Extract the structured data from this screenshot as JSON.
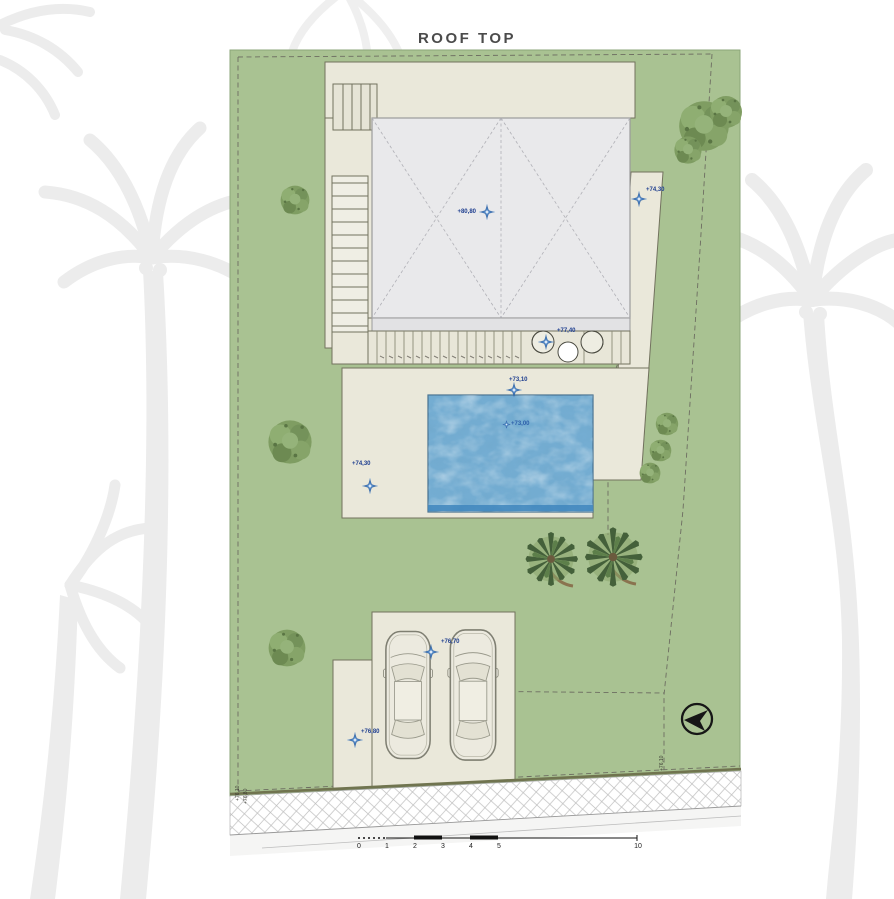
{
  "title": "ROOF TOP",
  "plan": {
    "name": "villa-roof-top-site-plan",
    "levels": [
      {
        "area": "roof",
        "label": "+80,80"
      },
      {
        "area": "terrace-east",
        "label": "+74,30"
      },
      {
        "area": "pergola-deck",
        "label": "+77,40"
      },
      {
        "area": "pool-deck-north",
        "label": "+73,10"
      },
      {
        "area": "pool-water",
        "label": "+73,00"
      },
      {
        "area": "pool-deck-west",
        "label": "+74,30"
      },
      {
        "area": "driveway-north",
        "label": "+76,70"
      },
      {
        "area": "driveway-west",
        "label": "+76,80"
      }
    ],
    "boundary_labels": [
      {
        "label": "+76,10"
      },
      {
        "label": "+76,80"
      },
      {
        "label": "+76,10"
      }
    ]
  },
  "scale_bar": {
    "labels": [
      "0",
      "1",
      "2",
      "3",
      "4",
      "5",
      "10"
    ]
  },
  "icons": {
    "north_arrow": "compass-circle-arrow",
    "level_marker": "blue-sparkle-cross"
  },
  "colors": {
    "grass": "#a9c292",
    "terrace": "#eae8da",
    "roof": "#e9e9eb",
    "pool_water": "#74add2",
    "pool_edge": "#3f86bd",
    "marker_blue": "#4e86c6",
    "marker_text": "#1e3e8f",
    "tree_olive": "#7f9d62",
    "palm_green": "#44603a",
    "wall_line": "#70744f",
    "watermark": "#ececec"
  }
}
